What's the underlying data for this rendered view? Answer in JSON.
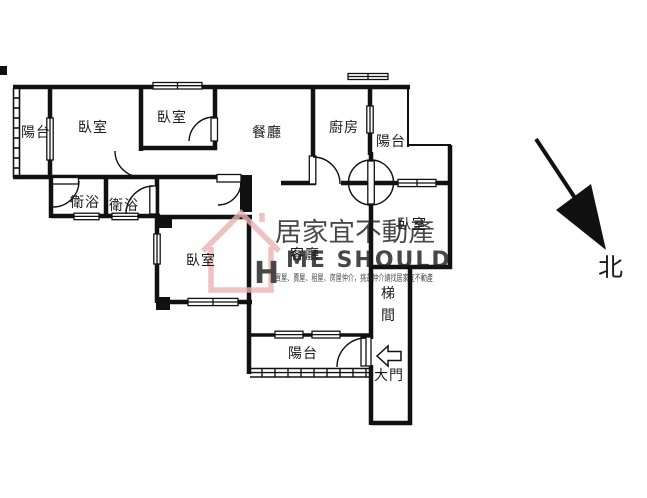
{
  "rooms": {
    "balcony_left": "陽台",
    "bedroom_top_left": "臥室",
    "bedroom_top_mid": "臥室",
    "dining_room": "餐廳",
    "kitchen": "廚房",
    "balcony_top_right": "陽台",
    "bathroom_1": "衛浴",
    "bathroom_2": "衛浴",
    "bedroom_mid_left": "臥室",
    "living_room": "客廳",
    "bedroom_right": "臥室",
    "stairwell_char_1": "梯",
    "stairwell_char_2": "間",
    "balcony_bottom": "陽台",
    "main_door": "大門"
  },
  "compass": {
    "north_label": "北"
  },
  "watermark": {
    "brand": "居家宜不動產",
    "logo_h": "H",
    "logo_text": "ME SHOULD",
    "tagline": "買屋、賣屋、租屋、房屋仲介，挑選仲介請找居家宜不動產"
  },
  "colors": {
    "wall": "#111111",
    "background": "#ffffff",
    "watermark_pink": "#e8a4a4"
  }
}
